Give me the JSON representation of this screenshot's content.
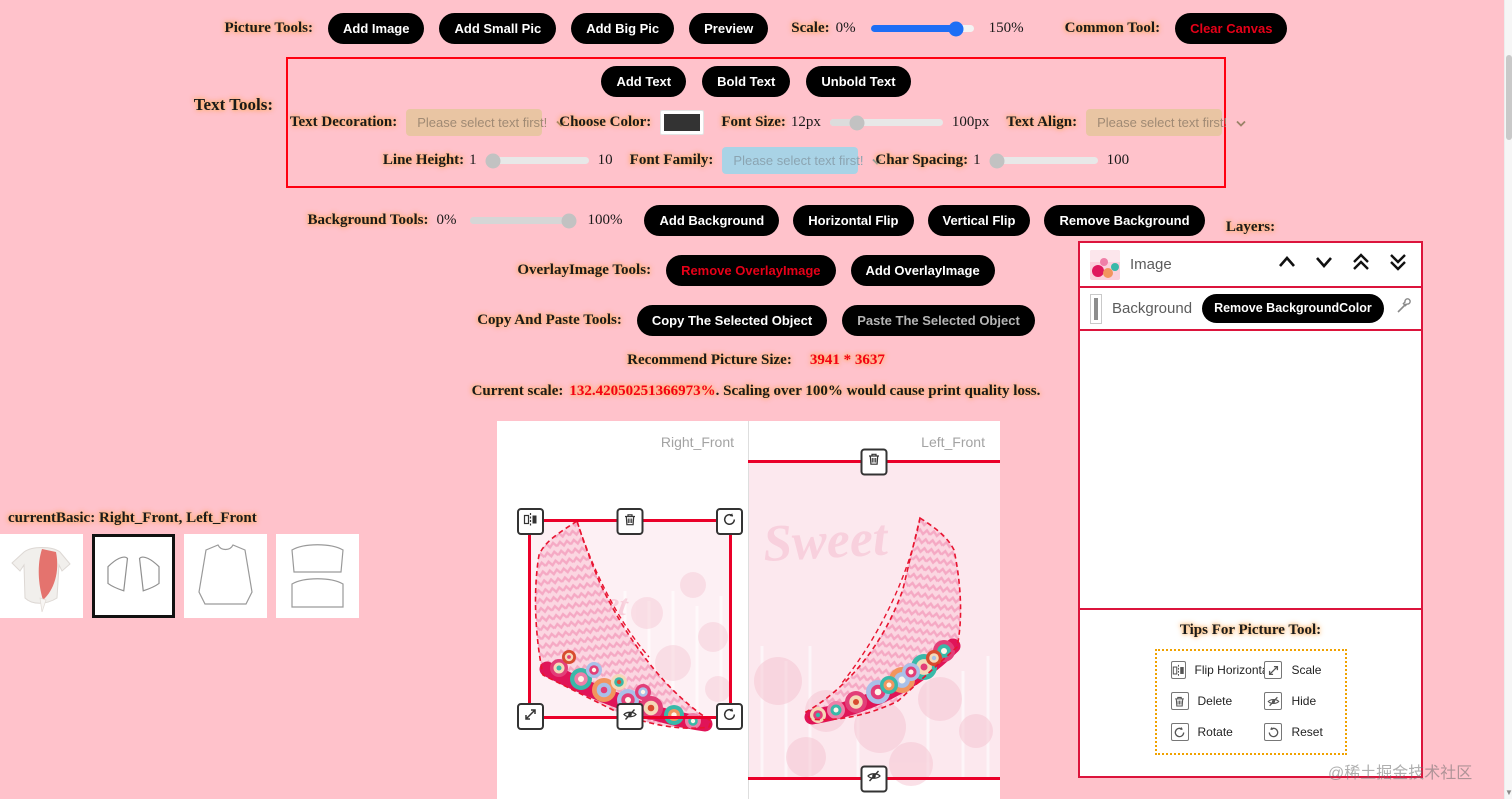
{
  "page": {
    "background": "#ffc2cb",
    "watermark": "@稀土掘金技术社区"
  },
  "colors": {
    "accent_red": "#ea0029",
    "panel_border": "#dc143c",
    "button_bg": "#000000",
    "slider_blue": "#1e6ef5",
    "select_tan": "#e9c5a3",
    "select_blue": "#a9d3e6",
    "chosen_color": "#333333"
  },
  "picture_tools": {
    "label": "Picture Tools:",
    "buttons": [
      "Add Image",
      "Add Small Pic",
      "Add Big Pic",
      "Preview"
    ],
    "scale_label": "Scale:",
    "scale_min": "0%",
    "scale_max": "150%",
    "common_tool_label": "Common Tool:",
    "clear_canvas_label": "Clear Canvas"
  },
  "text_tools": {
    "label": "Text Tools:",
    "add_text": "Add Text",
    "bold_text": "Bold Text",
    "unbold_text": "Unbold Text",
    "text_decoration_label": "Text Decoration:",
    "text_decoration_value": "Please select text first!",
    "choose_color_label": "Choose Color:",
    "font_size_label": "Font Size:",
    "font_size_value": "12px",
    "font_size_max": "100px",
    "text_align_label": "Text Align:",
    "text_align_value": "Please select text first!",
    "line_height_label": "Line Height:",
    "line_height_value": "1",
    "line_height_max": "10",
    "font_family_label": "Font Family:",
    "font_family_value": "Please select text first!",
    "char_spacing_label": "Char Spacing:",
    "char_spacing_value": "1",
    "char_spacing_max": "100"
  },
  "background_tools": {
    "label": "Background Tools:",
    "opacity_min": "0%",
    "opacity_max": "100%",
    "buttons": [
      "Add Background",
      "Horizontal Flip",
      "Vertical Flip",
      "Remove Background"
    ]
  },
  "overlay_tools": {
    "label": "OverlayImage Tools:",
    "remove_label": "Remove OverlayImage",
    "add_label": "Add OverlayImage"
  },
  "copy_paste_tools": {
    "label": "Copy And Paste Tools:",
    "copy_label": "Copy The Selected Object",
    "paste_label": "Paste The Selected Object"
  },
  "info": {
    "recommend_label": "Recommend Picture Size:",
    "recommend_value": "3941 * 3637",
    "current_scale_label": "Current scale:",
    "current_scale_value": "132.42050251366973%",
    "current_scale_suffix": ". Scaling over 100% would cause print quality loss."
  },
  "canvas": {
    "right_panel_label": "Right_Front",
    "left_panel_label": "Left_Front",
    "design_text": "Sweet",
    "handle_icons": [
      "flip-horizontal",
      "delete",
      "rotate",
      "scale",
      "hide",
      "reset"
    ]
  },
  "layers": {
    "title": "Layers:",
    "rows": [
      {
        "label": "Image"
      },
      {
        "label": "Background",
        "action": "Remove BackgroundColor"
      }
    ]
  },
  "tips": {
    "title": "Tips For Picture Tool:",
    "items": [
      {
        "icon": "flip-horizontal-icon",
        "label": "Flip Horizontal"
      },
      {
        "icon": "scale-icon",
        "label": "Scale"
      },
      {
        "icon": "delete-icon",
        "label": "Delete"
      },
      {
        "icon": "hide-icon",
        "label": "Hide"
      },
      {
        "icon": "rotate-icon",
        "label": "Rotate"
      },
      {
        "icon": "reset-icon",
        "label": "Reset"
      }
    ]
  },
  "current_basic": {
    "label": "currentBasic: Right_Front, Left_Front"
  }
}
